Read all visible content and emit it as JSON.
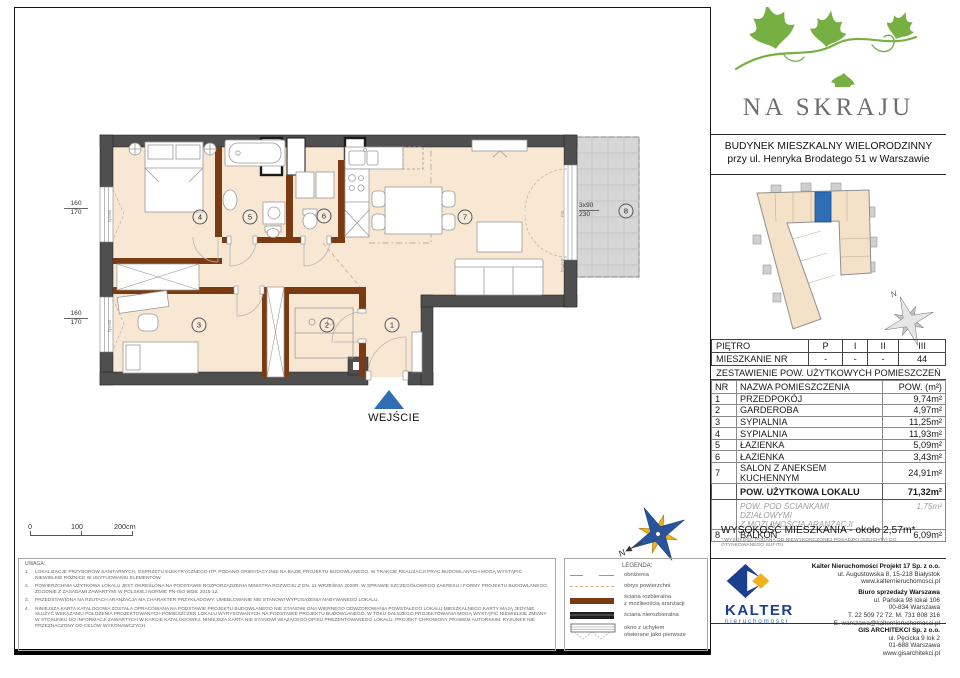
{
  "brand": {
    "name": "NA SKRAJU"
  },
  "project": {
    "line1": "BUDYNEK MIESZKALNY WIELORODZINNY",
    "line2": "przy ul. Henryka Brodatego 51 w Warszawie"
  },
  "location_table": {
    "rows": [
      {
        "label": "PIĘTRO",
        "values": [
          "P",
          "I",
          "II",
          "III"
        ]
      },
      {
        "label": "MIESZKANIE NR",
        "values": [
          "-",
          "-",
          "-",
          "44"
        ]
      }
    ]
  },
  "area_table": {
    "title": "ZESTAWIENIE POW. UŻYTKOWYCH POMIESZCZEŃ",
    "col_nr": "NR",
    "col_name": "NAZWA POMIESZCZENIA",
    "col_area": "POW. (m²)",
    "rooms": [
      {
        "nr": "1",
        "name": "PRZEDPOKÓJ",
        "area": "9,74m²"
      },
      {
        "nr": "2",
        "name": "GARDEROBA",
        "area": "4,97m²"
      },
      {
        "nr": "3",
        "name": "SYPIALNIA",
        "area": "11,25m²"
      },
      {
        "nr": "4",
        "name": "SYPIALNIA",
        "area": "11,93m²"
      },
      {
        "nr": "5",
        "name": "ŁAZIENKA",
        "area": "5,09m²"
      },
      {
        "nr": "6",
        "name": "ŁAZIENKA",
        "area": "3,43m²"
      },
      {
        "nr": "7",
        "name": "SALON Z ANEKSEM KUCHENNYM",
        "area": "24,91m²"
      }
    ],
    "total_label": "POW. UŻYTKOWA LOKALU",
    "total_value": "71,32m²",
    "partition_line1": "POW. POD ŚCIANKAMI DZIAŁOWYMI",
    "partition_line2": "Z MOŻLIWOŚCIĄ ARANŻACJI",
    "partition_value": "1,75m²",
    "balcony": {
      "nr": "8",
      "name": "BALKON",
      "area": "6,09m²"
    },
    "height_note": "WYSOKOŚĆ MIESZKANIA - około 2,57m*",
    "height_footnote": "* WYSOKOŚĆ PODANA OD NIEWYKOŃCZONEJ POSADZKI (SZLICHTY) DO OTYNKOWANEGO SUFITU"
  },
  "plan": {
    "entrance_label": "WEJŚCIE",
    "north_letter": "N",
    "room_markers": [
      {
        "nr": "1",
        "x": 332,
        "y": 213
      },
      {
        "nr": "2",
        "x": 267,
        "y": 213
      },
      {
        "nr": "3",
        "x": 139,
        "y": 213
      },
      {
        "nr": "4",
        "x": 140,
        "y": 105
      },
      {
        "nr": "5",
        "x": 190,
        "y": 105
      },
      {
        "nr": "6",
        "x": 264,
        "y": 104
      },
      {
        "nr": "7",
        "x": 405,
        "y": 105
      },
      {
        "nr": "8",
        "x": 566,
        "y": 99
      }
    ],
    "window_dims": [
      {
        "w": "160",
        "h": "170",
        "x": 4,
        "y": 88
      },
      {
        "w": "160",
        "h": "170",
        "x": 4,
        "y": 198
      }
    ],
    "balcony_dim": {
      "line1": "3x90",
      "line2": "230",
      "x": 519,
      "y": 90
    },
    "annotations": [
      {
        "text": "hp=60",
        "x": 47,
        "y": 110
      },
      {
        "text": "hp=60",
        "x": 47,
        "y": 220
      },
      {
        "text": "FIX",
        "x": 500,
        "y": 105
      },
      {
        "text": "hp=0,0",
        "x": 500,
        "y": 160
      }
    ],
    "scale_labels": [
      "0",
      "100",
      "200cm"
    ]
  },
  "legend": {
    "title": "LEGENDA:",
    "items": [
      {
        "type": "lower",
        "label": [
          "obniżenia"
        ]
      },
      {
        "type": "outline",
        "label": [
          "obrys powierzchni"
        ]
      },
      {
        "type": "removable",
        "label": [
          "ściana rozbieralna",
          "z możliwością aranżacji"
        ]
      },
      {
        "type": "solid",
        "label": [
          "ściana nierozbieralna"
        ]
      },
      {
        "type": "window",
        "label": [
          "okno z uchyłem",
          "otwierane jako pierwsze"
        ]
      }
    ]
  },
  "notes": {
    "title": "UWAGA:",
    "items": [
      "LOKALIZACJE PRZYBORÓW SANITARNYCH, OSPRZĘTU ELEKTRYCZNEGO ITP. PODANO ORIENTACYJNIE NA BAZIE PROJEKTU BUDOWLANEGO. W TRAKCIE REALIZACJI PRAC BUDOWLANYCH MOGĄ WYSTĄPIĆ NIEWIELKIE RÓŻNICE W USYTUOWANIU ELEMENTÓW.",
      "POWIERZCHNIA UŻYTKOWA LOKALU JEST OKREŚLONA NA PODSTAWIE ROZPORZĄDZENIA MINISTRA ROZWOJU Z DN. 11 WRZEŚNIA 2020R. W SPRAWIE SZCZEGÓŁOWEGO ZAKRESU I FORMY PROJEKTU BUDOWLANEGO, ZGODNIE Z ZASADAMI ZAWARTYMI W POLSKIEJ NORMIE PN-ISO 9836: 2015-12.",
      "PRZEDSTAWIONA NA RZUTACH ARANŻACJA MA CHARAKTER PRZYKŁADOWY. UMEBLOWANIE NIE STANOWI WYPOSAŻENIA NABYWANEGO LOKALU.",
      "NINIEJSZA KARTA KATALOGOWA ZOSTAŁA OPRACOWANA NA PODSTAWIE PROJEKTU BUDOWLANEGO NIE STANOWI ONA WIERNEGO ODWZOROWANIA POWSTAŁEGO LOKALU MIESZKALNEGO KARTY MAJĄ JEDYNIE SŁUŻYĆ WSKAZANIU POŁOŻENIA PROJEKTOWANYCH POMIESZCZEŃ LOKALU WYRYSOWANYCH NA PODSTAWIE PROJEKTU BUDOWLANEGO. W TOKU DALSZEGO PROJEKTOWANIA MOGĄ WYSTĄPIĆ NIEWIELKIE ZMIANY W STOSUNKU DO INFORMACJI ZAWARTYCH W KARCIE KATALOGOWEJ. NINIEJSZA KARTA NIE STANOWI WIĄŻĄCEGO OPISU PREZENTOWANEGO LOKALU. PROJEKT CHRONIONY PRAWEM AUTORSKIM. RYSUNEK NIE PRZEZNACZONY DO CELÓW WYKONAWCZYCH."
    ]
  },
  "developer": {
    "logo_title": "KALTER",
    "logo_subtitle": "nieruchomości",
    "company": "Kalter Nieruchomości Projekt 17 Sp. z o.o.",
    "company_lines": [
      "ul. Augustowska 8, 15-218 Białystok",
      "www.kalternieruchomosci.pl"
    ],
    "office": "Biuro sprzedaży Warszawa",
    "office_lines": [
      "ul. Pańska 98 lokal 106",
      "00-834 Warszawa",
      "T. 22 509 72 72. M. 731 808 316",
      "E. warszawa@kalternieruchomosci.pl"
    ],
    "architect": "GIS ARCHITEKCI Sp. z o.o.",
    "architect_lines": [
      "ul. Pęcicka 9 lok 2",
      "01-688 Warszawa",
      "www.gisarchitekci.pl"
    ]
  },
  "colors": {
    "accent_blue": "#2f6db5",
    "wall_dark": "#4f4f4f",
    "wall_removable": "#7a3a12",
    "room_fill": "#f8e7d2",
    "balcony_fill": "#d6d6d6",
    "logo_green": "#76b043",
    "kalter_blue": "#1b3f8f",
    "kalter_yellow": "#f0af1c"
  }
}
